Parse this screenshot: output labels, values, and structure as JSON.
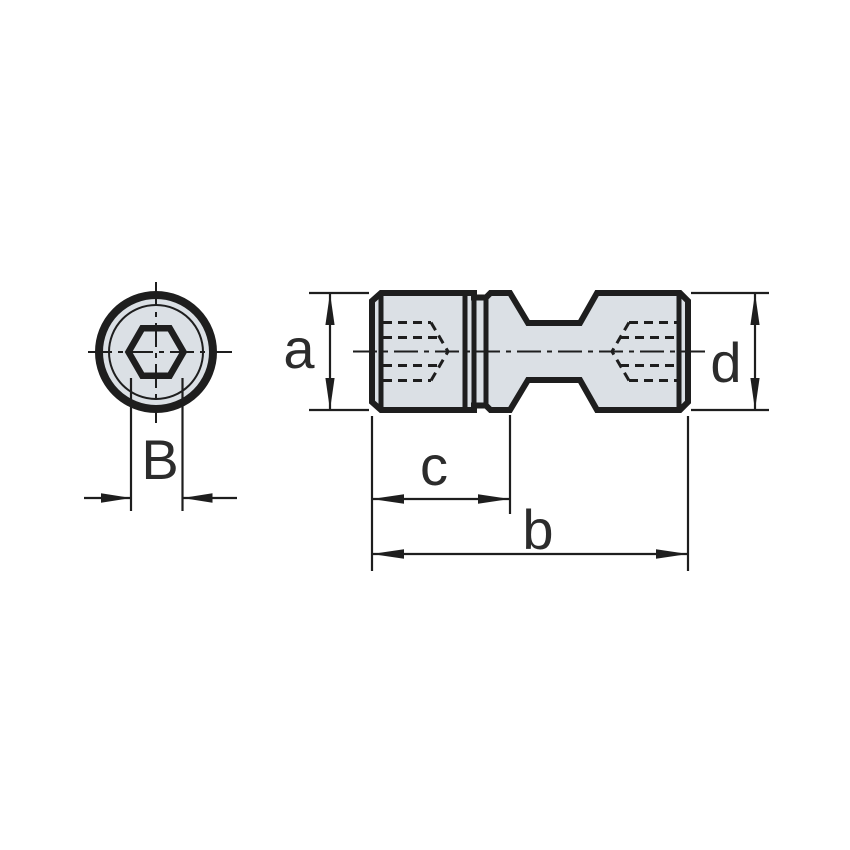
{
  "drawing": {
    "background_color": "#ffffff",
    "line_color": "#1e1e1e",
    "part_fill_color": "#dbe0e5",
    "text_color": "#2c2c2c",
    "labels": {
      "a": "a",
      "b": "b",
      "c": "c",
      "d": "d",
      "B": "B"
    }
  }
}
